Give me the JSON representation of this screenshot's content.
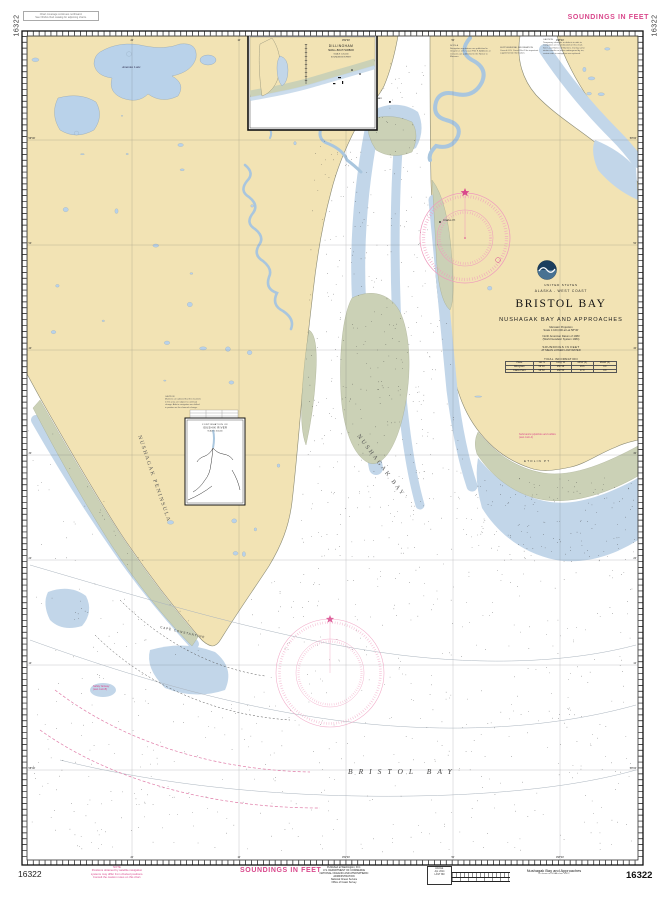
{
  "chart": {
    "number": "16322"
  },
  "colors": {
    "land": "#f2e3b4",
    "flats": "#cbd1b6",
    "shallow": "#c2d6e9",
    "magenta": "#d9488c",
    "rose": "#ef9abd"
  },
  "margins": {
    "left_rotated_number": "16322",
    "right_rotated_number": "16322",
    "soundings_top": "SOUNDINGS IN FEET",
    "soundings_bottom": "SOUNDINGS IN FEET",
    "top_note_lines": [
      "Chart coverage continues northward.",
      "See NOAA chart catalog for adjoining charts."
    ],
    "bottom_left_number": "16322",
    "bottom_right_number": "16322",
    "bottom_magenta_lines": [
      "NOTE",
      "Positions obtained by satellite navigation",
      "systems may differ from charted positions.",
      "Consult the caution notes on this chart."
    ],
    "publisher_lines": [
      "Published at Washington, D.C.",
      "U.S. DEPARTMENT OF COMMERCE",
      "NATIONAL OCEANIC AND ATMOSPHERIC ADMINISTRATION",
      "National Ocean Service",
      "Office of Coast Survey"
    ],
    "edition_lines": [
      "43rd Ed.",
      "Apr. 2014",
      "LAST NM"
    ],
    "series_title": "Nushagak Bay and Approaches",
    "series_sub": "as shown on NOAA chart 16322"
  },
  "title_block": {
    "country": "UNITED STATES",
    "region": "ALASKA - WEST COAST",
    "title": "BRISTOL BAY",
    "subtitle": "NUSHAGAK BAY AND APPROACHES",
    "projection": "Mercator Projection",
    "scale": "Scale 1:100,000 at Lat 58°30'",
    "datum": "North American Datum of 1983",
    "datum_sub": "(World Geodetic System 1984)",
    "soundings": "SOUNDINGS IN FEET",
    "soundings_sub": "AT MEAN LOWER LOW WATER",
    "table": {
      "title": "TIDAL INFORMATION",
      "headers": [
        "Place",
        "Lat. N",
        "Long. W",
        "MHW (ft)",
        "MLLW (ft)"
      ],
      "rows": [
        [
          "Dillingham",
          "59°03'",
          "158°28'",
          "19.6",
          "0.0"
        ],
        [
          "Clarks Point",
          "58°50'",
          "158°33'",
          "17.9",
          "0.0"
        ]
      ]
    }
  },
  "insets": {
    "a": {
      "title": "DILLINGHAM",
      "sub": "SMALL-BOAT HARBOR",
      "scale": "SCALE 1:20,000",
      "soundings": "SOUNDINGS IN FEET"
    },
    "b": {
      "title": "CONTINUATION OF",
      "sub": "IGUSHIK RIVER",
      "scale": "SCALE 1:100,000"
    }
  },
  "labels": {
    "peninsula": "NUSHAGAK PENINSULA",
    "bay": "NUSHAGAK BAY",
    "bristol": "BRISTOL BAY",
    "etolin": "ETOLIN PT",
    "cape": "CAPE CONSTANTINE",
    "amanka": "Amanka Lake",
    "dillingham": "Dillingham",
    "clarks": "Clarks Pt"
  },
  "notes": {
    "note_a_lines": [
      "NOTE A",
      "Navigation regulations are published in",
      "Chapter 2, U.S. Coast Pilot 9. Additions or",
      "revisions are published in the Notice to",
      "Mariners."
    ],
    "caution_top_lines": [
      "CAUTION",
      "Temporary changes or defects in aids to",
      "navigation are not indicated on this chart.",
      "See Local Notice to Mariners. During some",
      "winter months or when endangered by ice,",
      "certain aids to navigation are replaced."
    ],
    "supp_lines": [
      "SUPPLEMENTAL INFORMATION",
      "Consult U.S. Coast Pilot 9 for important",
      "supplemental information."
    ],
    "caution_inset_lines": [
      "CAUTION",
      "Mariners are advised that the channels",
      "in this area are subject to continual",
      "change. Aids to navigation are shifted",
      "in position as the channels change."
    ],
    "pipeline_lines": [
      "Submarine pipelines and cables",
      "(see note A)"
    ],
    "fairway_lines": [
      "Safety fairway",
      "(see note B)"
    ]
  },
  "graticule": {
    "top": [
      "20'",
      "10'",
      "159°00'",
      "50'",
      "158°40'"
    ],
    "bottom": [
      "20'",
      "10'",
      "159°00'",
      "50'",
      "158°40'"
    ],
    "left": [
      "59°00'",
      "50'",
      "40'",
      "30'",
      "20'",
      "10'",
      "58°00'"
    ],
    "right": [
      "59°00'",
      "50'",
      "40'",
      "30'",
      "20'",
      "10'",
      "58°00'"
    ]
  }
}
